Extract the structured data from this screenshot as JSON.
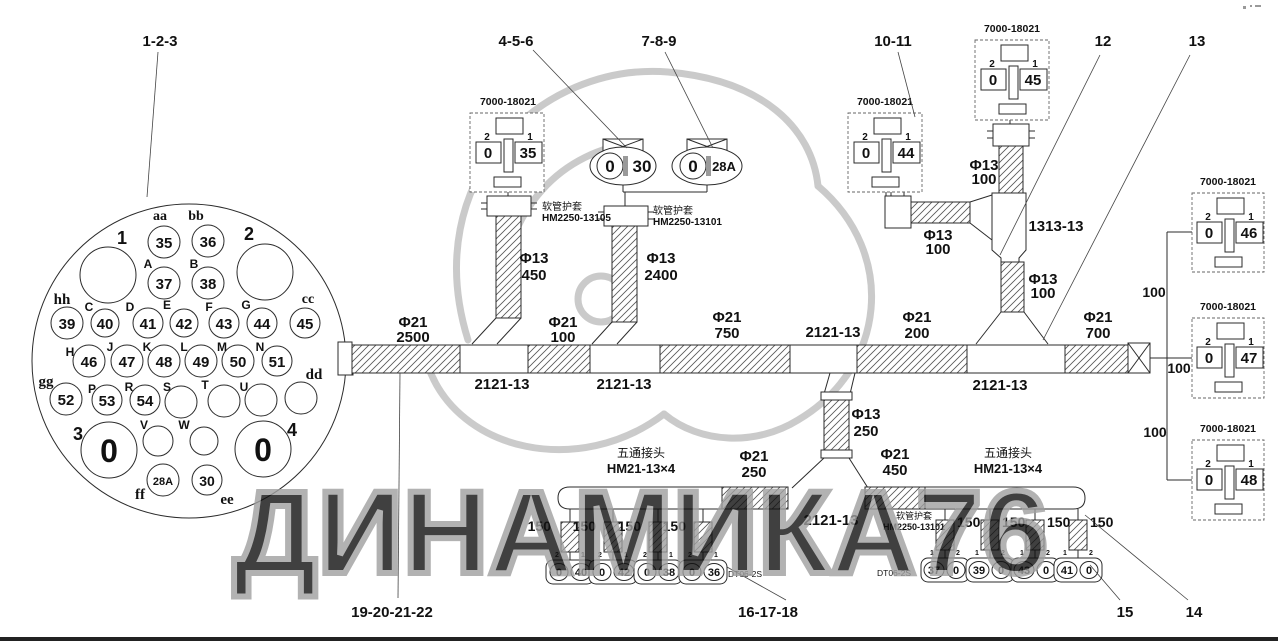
{
  "watermark": "ДИНАМИКА76",
  "callouts": {
    "c123": "1-2-3",
    "c456": "4-5-6",
    "c789": "7-8-9",
    "c1011": "10-11",
    "c12": "12",
    "c13": "13",
    "c14": "14",
    "c15": "15",
    "c161718": "16-17-18",
    "c19202122": "19-20-21-22"
  },
  "cc": {
    "pins": [
      {
        "l": "aa",
        "v": "35"
      },
      {
        "l": "bb",
        "v": "36"
      },
      {
        "l": "A",
        "v": "37"
      },
      {
        "l": "B",
        "v": "38"
      },
      {
        "l": "hh",
        "v": "39"
      },
      {
        "l": "C",
        "v": "40"
      },
      {
        "l": "D",
        "v": "41"
      },
      {
        "l": "E",
        "v": "42"
      },
      {
        "l": "F",
        "v": "43"
      },
      {
        "l": "G",
        "v": "44"
      },
      {
        "l": "cc",
        "v": "45"
      },
      {
        "l": "H",
        "v": "46"
      },
      {
        "l": "J",
        "v": "47"
      },
      {
        "l": "K",
        "v": "48"
      },
      {
        "l": "L",
        "v": "49"
      },
      {
        "l": "M",
        "v": "50"
      },
      {
        "l": "N",
        "v": "51"
      },
      {
        "l": "gg",
        "v": "52"
      },
      {
        "l": "P",
        "v": "53"
      },
      {
        "l": "R",
        "v": "54"
      },
      {
        "l": "S"
      },
      {
        "l": "T"
      },
      {
        "l": "U"
      },
      {
        "l": "dd"
      },
      {
        "l": "V"
      },
      {
        "l": "W"
      },
      {
        "l": "ff",
        "v": "28A"
      },
      {
        "l": "ee",
        "v": "30"
      }
    ],
    "holes": [
      {
        "l": "1"
      },
      {
        "l": "2"
      },
      {
        "l": "3",
        "v": "0"
      },
      {
        "l": "4",
        "v": "0"
      }
    ]
  },
  "blocks": {
    "part": "7000-18021",
    "pin2": "2",
    "pin1": "1",
    "tl": {
      "z": "0",
      "v": "35"
    },
    "b44": {
      "z": "0",
      "v": "44"
    },
    "b45": {
      "z": "0",
      "v": "45"
    },
    "b46": {
      "z": "0",
      "v": "46"
    },
    "b47": {
      "z": "0",
      "v": "47"
    },
    "b48": {
      "z": "0",
      "v": "48"
    }
  },
  "ovals": {
    "o1": {
      "z": "0",
      "v": "30"
    },
    "o2": {
      "z": "0",
      "v": "28A"
    }
  },
  "sleeves": {
    "s1a": "软管护套",
    "s1b": "HM2250-13105",
    "s2a": "软管护套",
    "s2b": "HM2250-13101",
    "s3a": "软管护套",
    "s3b": "HM2250-13101"
  },
  "manifold": {
    "cn": "五通接头",
    "pn": "HM21-13×4"
  },
  "dims": {
    "t2500a": "Φ21",
    "t2500b": "2500",
    "t100a": "Φ21",
    "t100b": "100",
    "t750a": "Φ21",
    "t750b": "750",
    "t200a": "Φ21",
    "t200b": "200",
    "t700a": "Φ21",
    "t700b": "700",
    "b450a": "Φ13",
    "b450b": "450",
    "b2400a": "Φ13",
    "b2400b": "2400",
    "f1a": "Φ13",
    "f1b": "100",
    "f2a": "Φ13",
    "f2b": "100",
    "f3a": "Φ13",
    "f3b": "100",
    "f250a": "Φ13",
    "f250b": "250",
    "m250a": "Φ21",
    "m250b": "250",
    "m450a": "Φ21",
    "m450b": "450"
  },
  "junctions": {
    "j1": "2121-13",
    "j2": "2121-13",
    "j3": "2121-13",
    "j4": "2121-13",
    "j5": "2121-13",
    "y": "1313-13"
  },
  "lens": {
    "h1": "100",
    "h2": "100",
    "h3": "100",
    "drop": "150"
  },
  "bottom": {
    "dt_l": "DT06-2S",
    "dt_r": "DT06-2S",
    "p1": "1",
    "p2": "2",
    "left": [
      {
        "a": "0",
        "b": "40"
      },
      {
        "a": "0",
        "b": "42"
      },
      {
        "a": "0",
        "b": "38"
      },
      {
        "a": "0",
        "b": "36"
      }
    ],
    "right": [
      {
        "a": "37",
        "b": "0"
      },
      {
        "a": "39",
        "b": "0"
      },
      {
        "a": "43",
        "b": "0"
      },
      {
        "a": "41",
        "b": "0"
      }
    ]
  }
}
